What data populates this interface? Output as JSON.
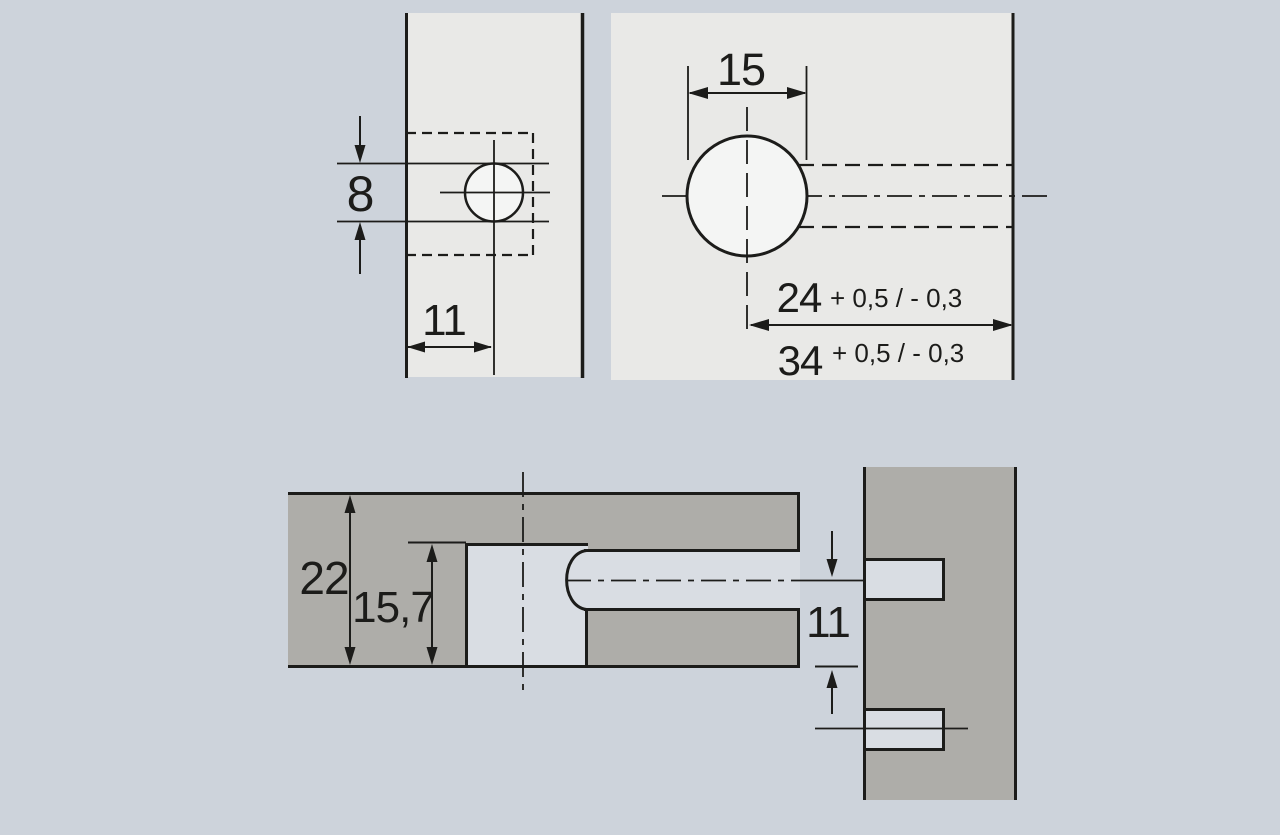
{
  "colors": {
    "background": "#cdd3db",
    "panel_face": "#e9e9e7",
    "board_section": "#aeada9",
    "hole_fill": "#f4f5f4",
    "bore_fill": "#d9dde3",
    "line": "#1c1c1a"
  },
  "edge_view": {
    "hole_diameter": "8",
    "edge_distance": "11"
  },
  "face_view": {
    "hole_diameter": "15",
    "depth_min": "24",
    "depth_min_tolerance": "+ 0,5 / - 0,3",
    "depth_max": "34",
    "depth_max_tolerance": "+ 0,5 / - 0,3"
  },
  "section_view": {
    "board_thickness": "22",
    "bore_depth": "15,7",
    "center_distance": "11"
  }
}
